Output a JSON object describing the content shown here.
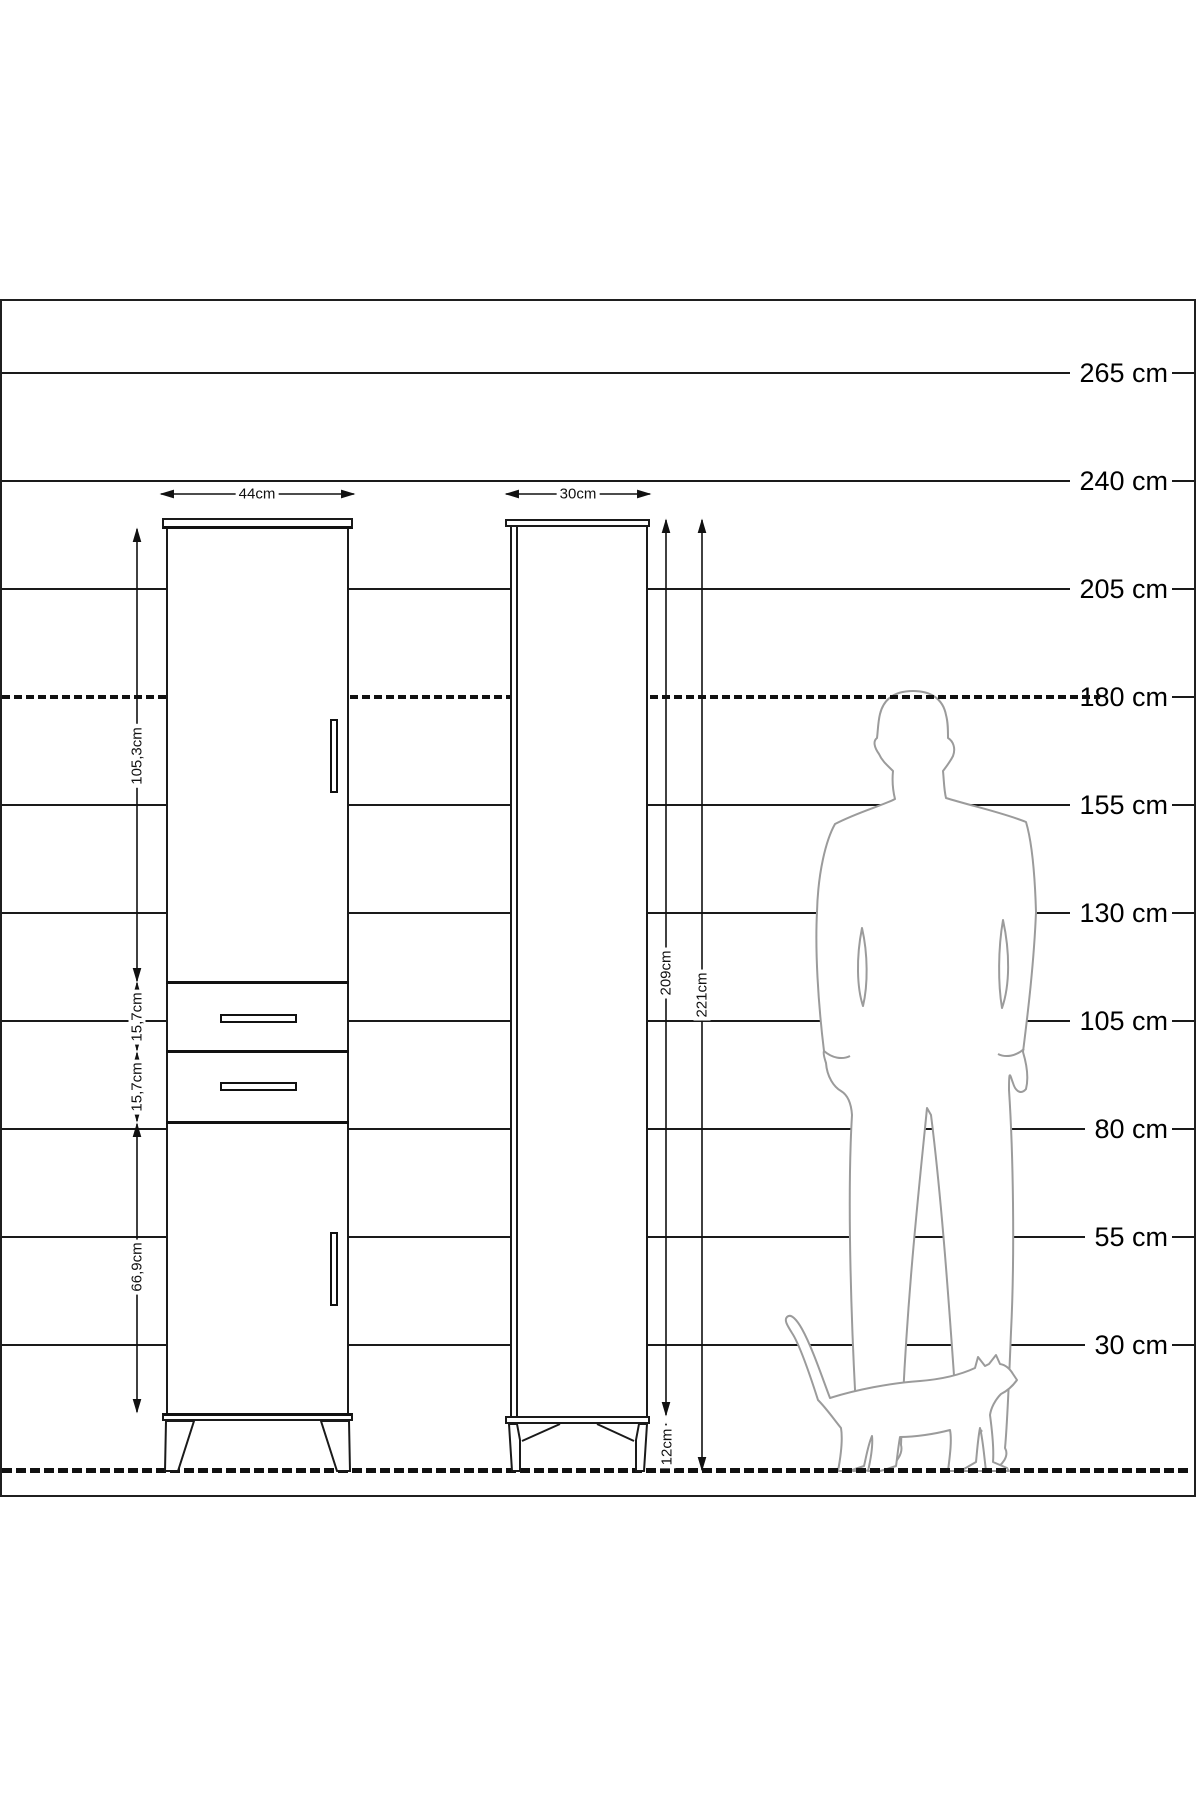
{
  "diagram": {
    "title_hint": "furniture dimension drawing with height ruler, front and side cabinet views, man and cat silhouettes for scale",
    "colors": {
      "background": "#ffffff",
      "line": "#1a1a1a",
      "silhouette": "#9b9b9b"
    },
    "ruler": {
      "rows": [
        {
          "label": "265 cm",
          "style": "solid"
        },
        {
          "label": "240 cm",
          "style": "solid"
        },
        {
          "label": "205 cm",
          "style": "solid"
        },
        {
          "label": "180 cm",
          "style": "dashed"
        },
        {
          "label": "155 cm",
          "style": "solid"
        },
        {
          "label": "130 cm",
          "style": "solid"
        },
        {
          "label": "105 cm",
          "style": "solid"
        },
        {
          "label": "80 cm",
          "style": "solid"
        },
        {
          "label": "55 cm",
          "style": "solid"
        },
        {
          "label": "30 cm",
          "style": "solid"
        }
      ]
    },
    "front_view": {
      "width": "44cm",
      "upper_door_height": "105,3cm",
      "drawer1_height": "15,7cm",
      "drawer2_height": "15,7cm",
      "lower_door_height": "66,9cm"
    },
    "side_view": {
      "depth": "30cm",
      "body_height": "209cm",
      "total_height": "221cm",
      "leg_height": "12cm"
    }
  }
}
